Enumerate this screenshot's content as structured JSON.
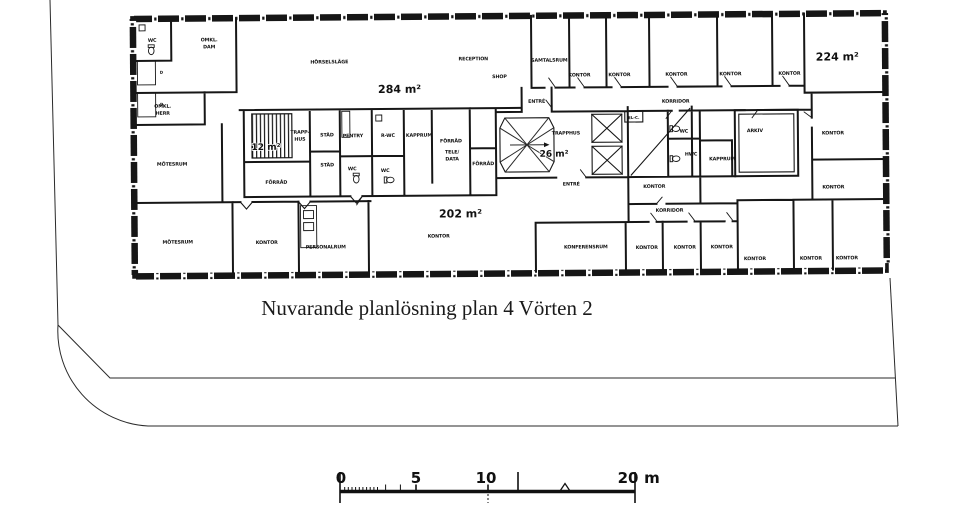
{
  "title": "Nuvarande planlösning plan 4 Vörten 2",
  "colors": {
    "ink": "#161616",
    "paper": "#ffffff"
  },
  "areas": {
    "open_plan": "284 m²",
    "northeast": "224 m²",
    "south": "202 m²",
    "stairwell": "26 m²",
    "west_stair": "12 m²"
  },
  "rooms": {
    "wc": "WC",
    "omkl": "OMKL.",
    "dam": "DAM",
    "herr": "HERR",
    "motesrum": "MÖTESRUM",
    "open_area": "HÖRSELSLÄGE",
    "reception": "RECEPTION",
    "shop": "SHOP",
    "samtalsrum": "SAMTALSRUM",
    "kontor": "KONTOR",
    "korridor": "KORRIDOR",
    "entre": "ENTRÉ",
    "trapphus": "TRAPPHUS",
    "trapp1": "TRAPP-",
    "trapp2": "HUS",
    "stad": "STÄD",
    "pentry": "PENTRY",
    "rwc": "R-WC",
    "hwc": "HWC",
    "kapprum": "KAPPRUM",
    "forrad": "FÖRRÅD",
    "tele": "TELE/",
    "data": "DATA",
    "personalrum": "PERSONALRUM",
    "konferensrum": "KONFERENSRUM",
    "arkiv": "ARKIV",
    "elc": "EL-C.",
    "locker": "D"
  },
  "scalebar": {
    "t0": "0",
    "t5": "5",
    "t10": "10",
    "t20": "20",
    "unit": "m"
  }
}
